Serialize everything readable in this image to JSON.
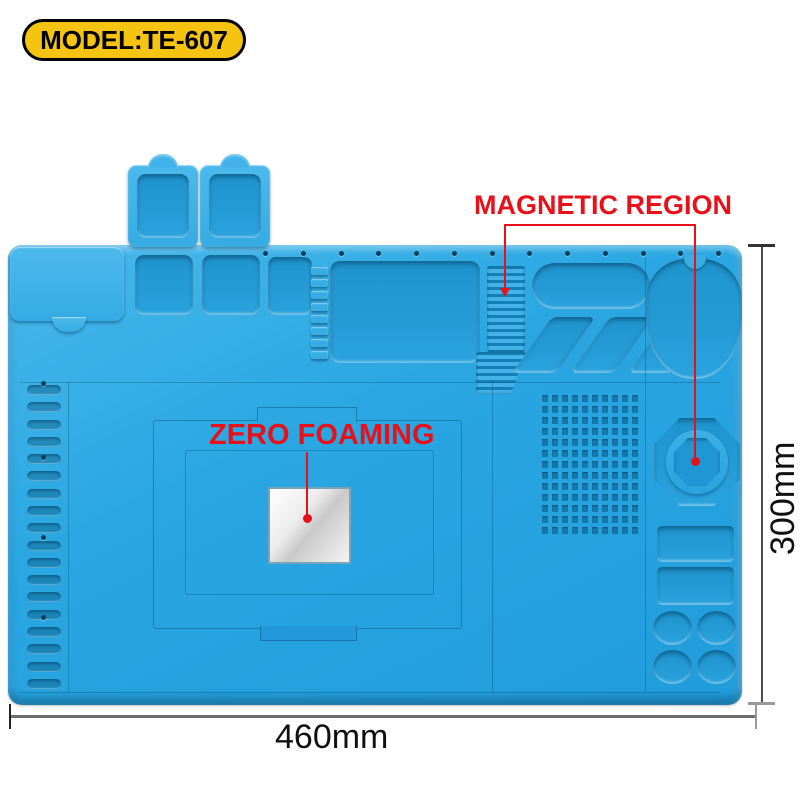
{
  "badge": {
    "label": "MODEL:TE-607"
  },
  "annotations": {
    "magnetic_region": {
      "label": "MAGNETIC REGION"
    },
    "zero_foaming": {
      "label": "ZERO FOAMING"
    }
  },
  "dimensions": {
    "width_label": "460mm",
    "height_label": "300mm"
  },
  "colors": {
    "mat_blue": "#2aa7e2",
    "annotation_red": "#e8111a",
    "badge_yellow": "#f5c411",
    "dimension_gray": "#6e6e6e"
  },
  "mat": {
    "description_counts": {
      "top_holes": 13,
      "comb_teeth": 8,
      "left_slots": 18,
      "grid_dots": 130,
      "diagonal_trays": 3,
      "clover_wells": 4
    }
  }
}
